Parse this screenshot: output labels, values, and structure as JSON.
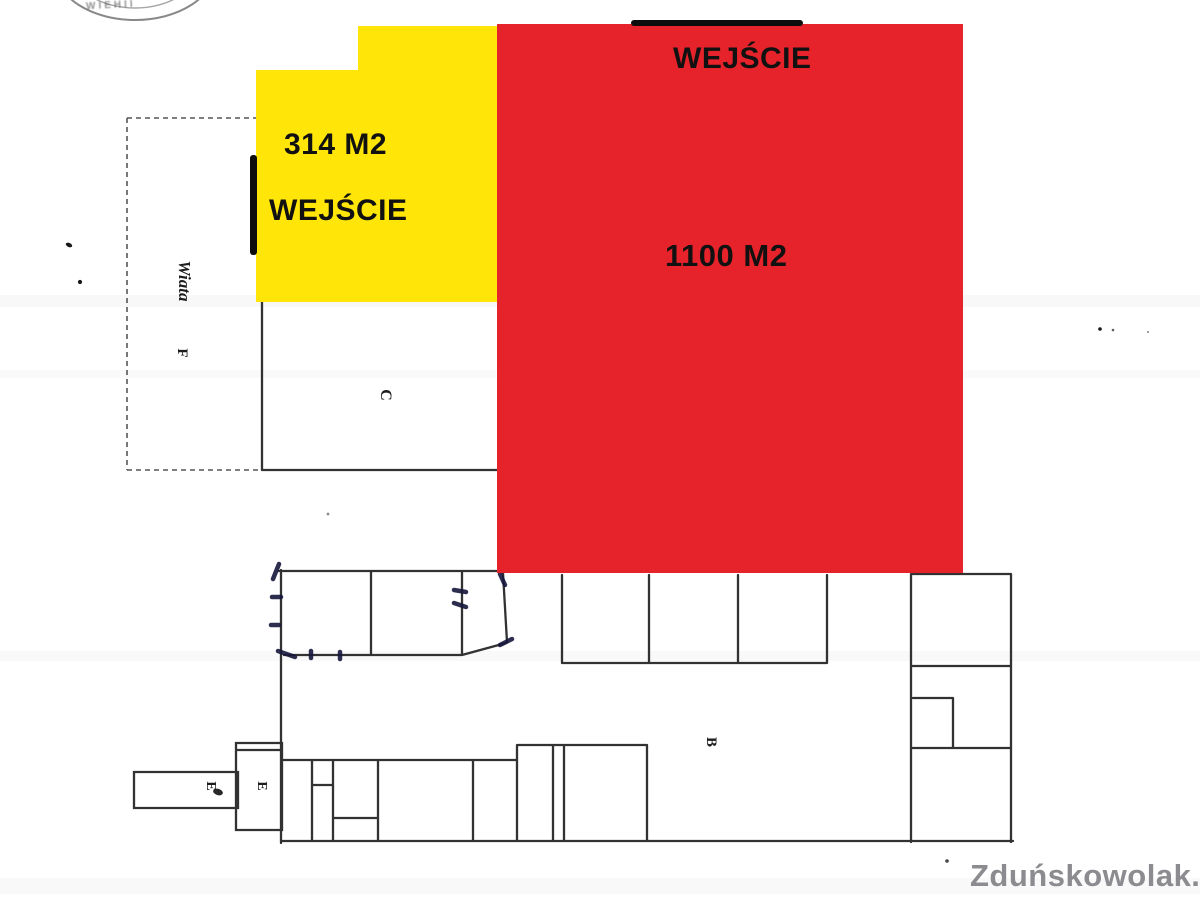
{
  "overlay_zones": {
    "yellow_zone": {
      "color": "#ffe608",
      "area_label": "314 M2",
      "entrance_label": "WEJŚCIE"
    },
    "red_zone": {
      "color": "#e6232b",
      "area_label": "1100 M2",
      "entrance_label": "WEJŚCIE"
    }
  },
  "floor_plan": {
    "labels": {
      "shelter": "Wiata",
      "room_f": "F",
      "room_c": "C",
      "hall_b": "B",
      "annex_e_left": "E",
      "annex_e_mid": "E"
    },
    "line_color": "#1c1c1c",
    "ink_mark_color": "#17173d"
  },
  "stamp": {
    "text": "WIEHII"
  },
  "watermark": {
    "text": "Zduńskowolak.pl",
    "color": "#8b8b90"
  }
}
